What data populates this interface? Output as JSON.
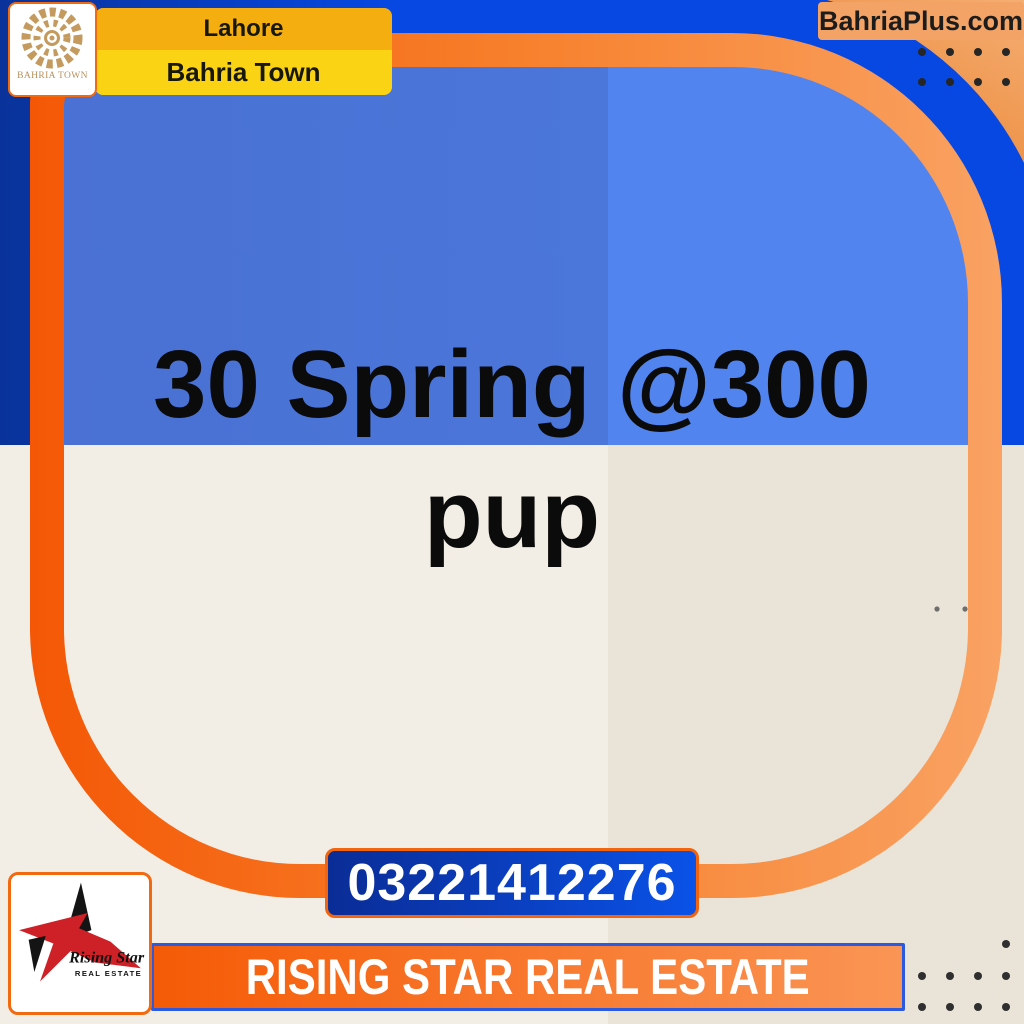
{
  "brand": {
    "logo_label": "BAHRIA TOWN",
    "location": "Lahore",
    "town": "Bahria Town",
    "website": "BahriaPlus.com"
  },
  "listing": {
    "headline": "30 Spring @300 pup",
    "headline_lines": [
      "30 Spring @300",
      "pup"
    ],
    "phone": "03221412276"
  },
  "agency": {
    "banner_text": "RISING STAR REAL ESTATE",
    "logo_title": "Rising Star",
    "logo_subtitle": "REAL ESTATE"
  },
  "colors": {
    "outer_navy": "#09339A",
    "outer_bright_blue": "#0748E2",
    "inner_blue_left": "#4A71D3",
    "inner_blue_right": "#5184EE",
    "cream_left": "#F2EEE6",
    "cream_right": "#EAE3D8",
    "frame_orange_left": "#F45806",
    "frame_orange_right": "#F9A263",
    "corner_peach_light": "#F5AE72",
    "corner_peach_dark": "#EA8636",
    "accent_yellow_top": "#F5AE0F",
    "accent_yellow_bottom": "#FAD414",
    "button_blue_dark": "#0A2C96",
    "button_blue_bright": "#0A52E8",
    "button_border": "#F2650E",
    "banner_border": "#2B59E0",
    "gold_logo": "#C49A5E",
    "star_red": "#CE2027",
    "text_black": "#0B0B0B"
  }
}
